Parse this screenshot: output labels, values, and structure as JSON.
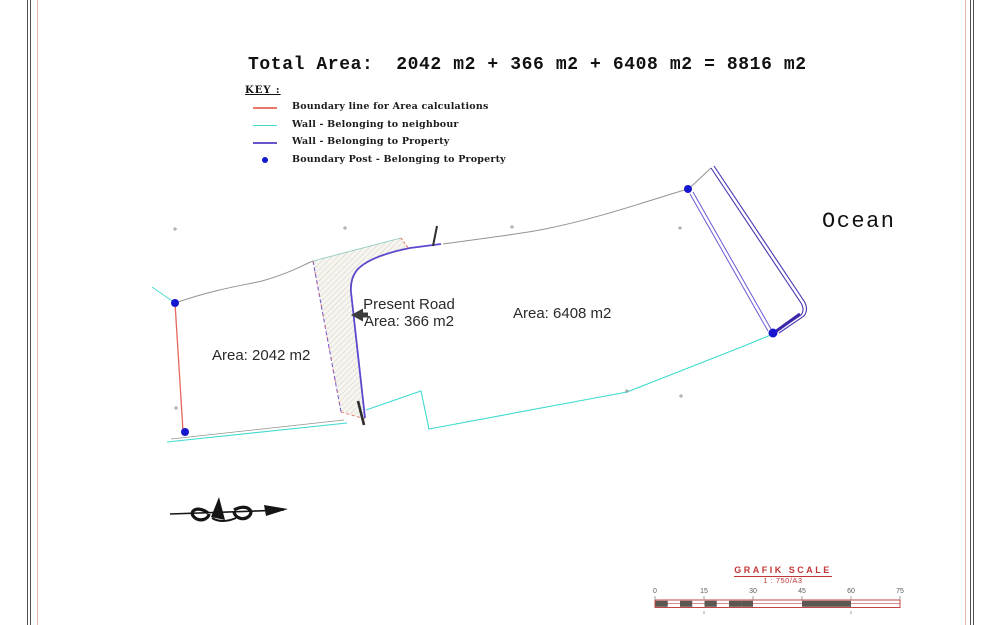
{
  "sheet": {
    "title": "Total Area:  2042 m2 + 366 m2 + 6408 m2 = 8816 m2",
    "ocean_label": "Ocean"
  },
  "key": {
    "heading": "KEY :",
    "items": [
      {
        "label": "Boundary line for Area calculations",
        "type": "line",
        "color": "#e8786c"
      },
      {
        "label": "Wall - Belonging to neighbour",
        "type": "line",
        "color": "#42d8cc"
      },
      {
        "label": "Wall - Belonging to Property",
        "type": "line",
        "color": "#6656cc"
      },
      {
        "label": "Boundary Post - Belonging to Property",
        "type": "dot",
        "color": "#1717cf"
      }
    ]
  },
  "parcels": {
    "left_area": "Area: 2042 m2",
    "road_name": "Present Road",
    "road_area": "Area: 366 m2",
    "right_area": "Area: 6408 m2"
  },
  "scale_bar": {
    "title": "GRAFIK SCALE",
    "ratio": "1 : 750/A3",
    "ticks": [
      "0",
      "15",
      "30",
      "45",
      "60",
      "75"
    ],
    "accent_color": "#c23737"
  },
  "plan_colors": {
    "boundary_red": "#e6685c",
    "neighbour_wall_cyan": "#3fdbd0",
    "property_wall_purple": "#5b48cc",
    "post_blue": "#1717cf",
    "survey_gray": "#94948c"
  }
}
